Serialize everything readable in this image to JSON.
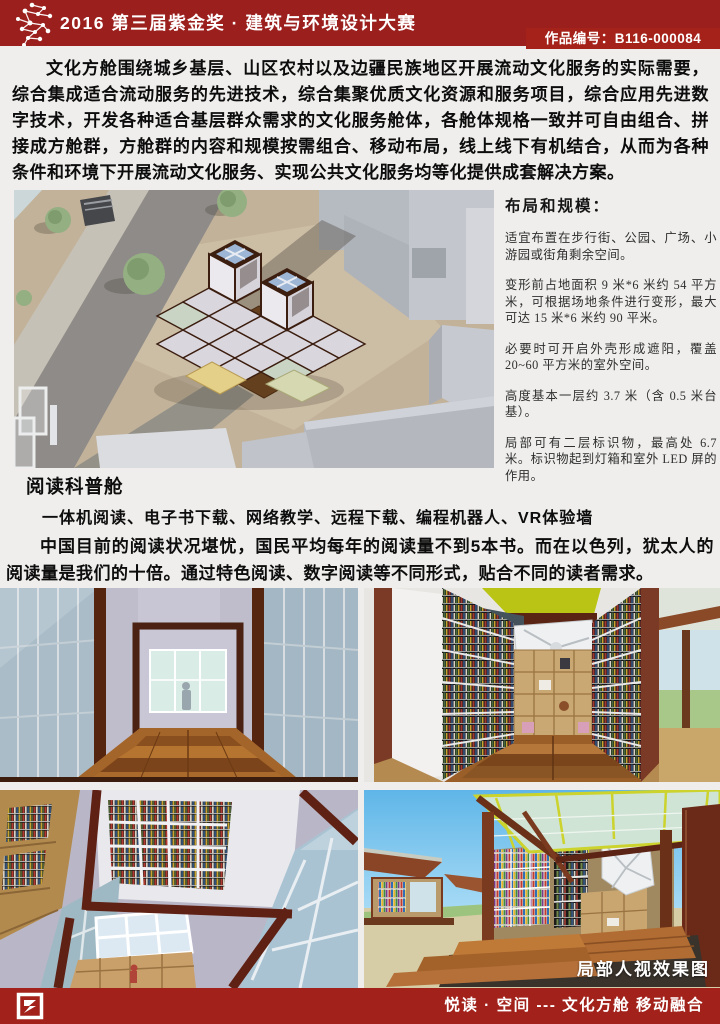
{
  "header": {
    "title": "2016 第三届紫金奖 · 建筑与环境设计大赛",
    "entry_label": "作品编号：B116-000084"
  },
  "palette": {
    "header_red": "#9b1f1d",
    "badge_red": "#a5221a",
    "footer_red": "#a2211b",
    "ceiling_green": "#b9c415",
    "frame_brown": "#4a2113"
  },
  "icons": {
    "header_logo": "constellation-logo-icon",
    "footer_logo": "seal-logo-icon"
  },
  "intro": {
    "text": "文化方舱围绕城乡基层、山区农村以及边疆民族地区开展流动文化服务的实际需要，综合集成适合流动服务的先进技术，综合集聚优质文化资源和服务项目，综合应用先进数字技术，开发各种适合基层群众需求的文化服务舱体，各舱体规格一致并可自由组合、拼接成方舱群，方舱群的内容和规模按需组合、移动布局，线上线下有机结合，从而为各种条件和环境下开展流动文化服务、实现公共文化服务均等化提供成套解决方案。"
  },
  "specs": {
    "heading": "布局和规模：",
    "items": [
      "适宜布置在步行街、公园、广场、小游园或街角剩余空间。",
      "变形前占地面积 9 米*6 米约 54 平方米，可根据场地条件进行变形，最大可达 15 米*6 米约 90 平米。",
      "必要时可开启外壳形成遮阳，覆盖 20~60 平方米的室外空间。",
      "高度基本一层约 3.7 米（含 0.5 米台基）。",
      "局部可有二层标识物，最高处 6.7 米。标识物起到灯箱和室外 LED 屏的作用。"
    ]
  },
  "reading": {
    "heading": "阅读科普舱",
    "line1": "一体机阅读、电子书下载、网络教学、远程下载、编程机器人、VR体验墙",
    "line2": "中国目前的阅读状况堪忧，国民平均每年的阅读量不到5本书。而在以色列，犹太人的阅读量是我们的十倍。通过特色阅读、数字阅读等不同形式，贴合不同的读者需求。"
  },
  "gallery": {
    "caption": "局部人视效果图",
    "images": [
      "aerial-plaza-render",
      "interior-corridor-render",
      "bookshelf-room-render",
      "atrium-lookup-render",
      "exterior-deck-render"
    ]
  },
  "footer": {
    "slogan": "悦读 · 空间 --- 文化方舱 移动融合"
  }
}
